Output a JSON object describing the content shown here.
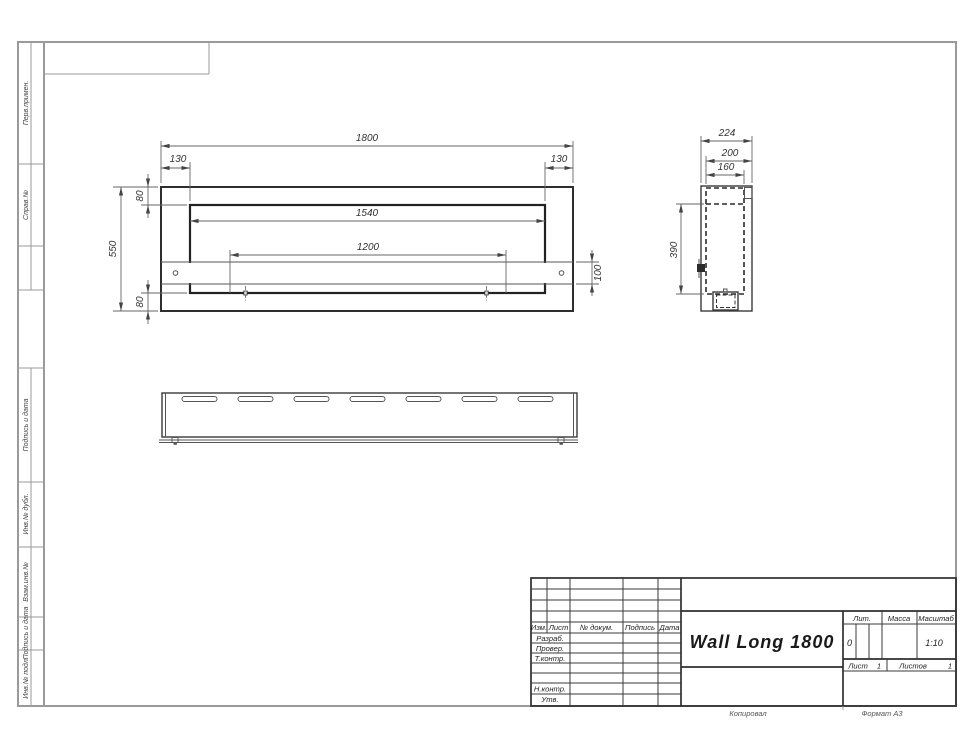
{
  "sheet": {
    "footer": {
      "copied": "Копировал",
      "format": "Формат А3"
    },
    "margins": {
      "perv": "Перв.примен.",
      "sprav": "Справ.№",
      "podp1": "Подпись и дата",
      "dubl": "Инв.№ дубл.",
      "vzam": "Взам.инв.№",
      "podp2": "Подпись и дата",
      "podl": "Инв.№ подл."
    }
  },
  "title_block": {
    "name": "Wall Long 1800",
    "cols": {
      "izm": "Изм.",
      "list": "Лист",
      "doc": "№ докум.",
      "podp": "Подпись",
      "data": "Дата"
    },
    "roles": {
      "razrab": "Разраб.",
      "prover": "Провер.",
      "tkontr": "Т.контр.",
      "nkontr": "Н.контр.",
      "utv": "Утв."
    },
    "lit": {
      "label": "Лит.",
      "value": "0"
    },
    "massa": {
      "label": "Масса"
    },
    "scale": {
      "label": "Масштаб",
      "value": "1:10"
    },
    "list_row": {
      "sheet_label": "Лист",
      "sheet_value": "1",
      "sheets_label": "Листов",
      "sheets_value": "1"
    }
  },
  "front_view": {
    "dims": {
      "total_width": "1800",
      "left_offset": "130",
      "right_offset": "130",
      "opening_width": "1540",
      "mount_span": "1200",
      "total_height": "550",
      "top_margin": "80",
      "bottom_margin": "80",
      "band_height": "100"
    }
  },
  "side_view": {
    "dims": {
      "depth": "224",
      "body_depth": "200",
      "inner_depth": "160",
      "body_height": "390"
    }
  }
}
